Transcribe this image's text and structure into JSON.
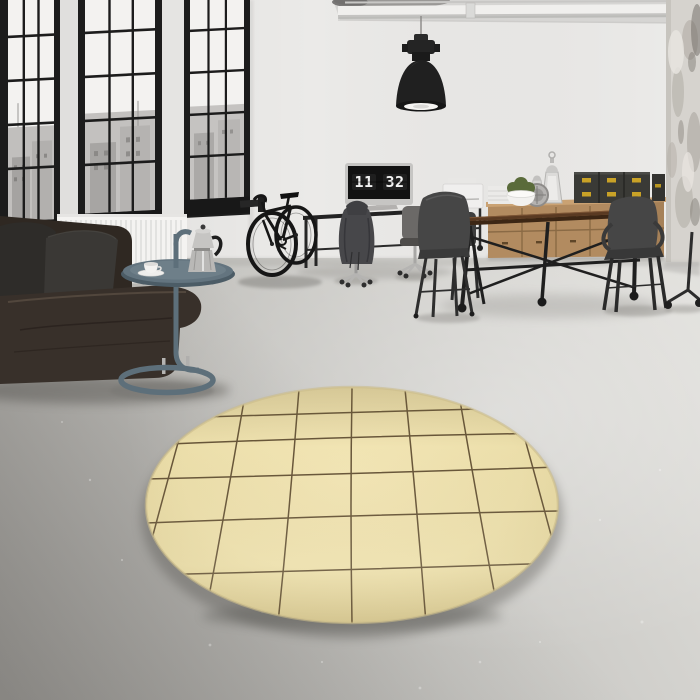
{
  "scene": {
    "description": "Sunlit industrial loft: black-framed factory windows, dark leather sofa with charcoal pillows, blue-steel tray side table with moka pot and cup, wall-mounted black bicycle, metal desk with monitor flip-clock, black pendant lamp, wooden dining table with dark metal chairs, oak sideboard with brass-latch trunks and lanterns, distressed concrete column, round beige grid rug on concrete floor",
    "monitor_clock": {
      "hours": "11",
      "minutes": "32"
    },
    "colors": {
      "wall": "#ebeae8",
      "ceiling": "#d6d5d3",
      "floor_dark": "#9f9d99",
      "floor_mid": "#c6c5c1",
      "floor_light": "#e0dfdb",
      "rug": "#ecdfab",
      "rug_line": "#55432a",
      "window_frame": "#1c1c1c",
      "glass": "#f3f2f0",
      "radiator": "#f4f3f1",
      "sofa_leather": "#38302a",
      "pillow_dark": "#2e2c29",
      "pillow_light": "#3a3835",
      "side_table": "#5d6f7a",
      "bike": "#161616",
      "desk_metal": "#232323",
      "monitor_silver": "#c6c5c3",
      "screen": "#121212",
      "digits": "#f2f2f2",
      "dining_top": "#5a3a22",
      "chair_metal": "#464646",
      "sideboard": "#b28b60",
      "trunk_box": "#3a3a36",
      "trunk_latch": "#c9a227",
      "plant": "#5a6b3a",
      "lamp": "#202020",
      "column": "#d6d3ce"
    }
  }
}
